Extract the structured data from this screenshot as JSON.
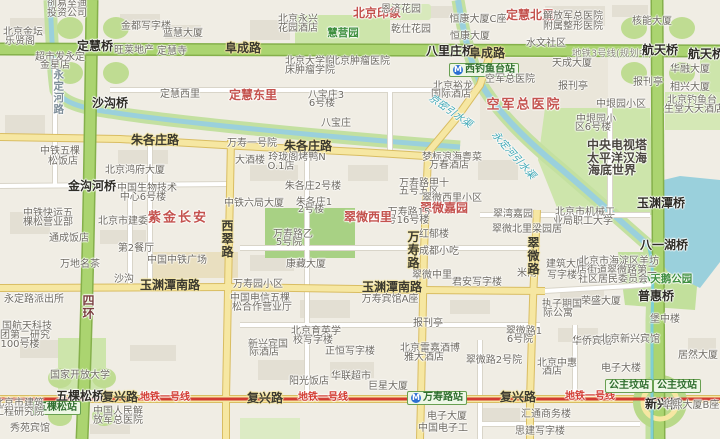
{
  "map": {
    "description": "Beijing street map around Fuxing Road / Wanshou Road / Gongzhufen",
    "colors": {
      "land": "#f0ede4",
      "park": "#cde5ab",
      "park_dark": "#a8d184",
      "highway_green": "#abd470",
      "highway_green_border": "#85b04b",
      "road_yellow": "#f6e7a2",
      "road_yellow_border": "#d9bd62",
      "road_white": "#ffffff",
      "road_white_border": "#d9d5c9",
      "water": "#9ad0dc",
      "water_bank": "#c3e0a0",
      "metro_line1_red": "#d23b32",
      "station_badge_bg": "#eef7e6",
      "station_badge_border": "#69a052",
      "district_label_red": "#c4524e",
      "building": "#e3dfd3"
    },
    "labels": [
      {
        "t": "北京印象",
        "c": "red",
        "x": 377,
        "y": 13
      },
      {
        "t": "定慧北里",
        "c": "red",
        "x": 530,
        "y": 15
      },
      {
        "t": "创易至迪",
        "c": "p",
        "x": 67,
        "y": 5
      },
      {
        "t": "投资公司",
        "c": "p",
        "x": 67,
        "y": 14
      },
      {
        "t": "北京金坛",
        "c": "p",
        "x": 23,
        "y": 33
      },
      {
        "t": "乐贤阁",
        "c": "p",
        "x": 20,
        "y": 42
      },
      {
        "t": "金都写字楼",
        "c": "p",
        "x": 146,
        "y": 27
      },
      {
        "t": "蓝慧大厦",
        "c": "p",
        "x": 183,
        "y": 34
      },
      {
        "t": "定慧桥",
        "c": "b",
        "x": 95,
        "y": 46
      },
      {
        "t": "旺莱地产",
        "c": "p",
        "x": 134,
        "y": 51
      },
      {
        "t": "定慧寺",
        "c": "p",
        "x": 172,
        "y": 52
      },
      {
        "t": "阜成路",
        "c": "r",
        "x": 243,
        "y": 48
      },
      {
        "t": "超市发永定",
        "c": "p",
        "x": 60,
        "y": 58
      },
      {
        "t": "金星店",
        "c": "p",
        "x": 55,
        "y": 66
      },
      {
        "t": "永定河路",
        "c": "vb",
        "x": 58,
        "y": 92
      },
      {
        "t": "定慧西里",
        "c": "p",
        "x": 180,
        "y": 95
      },
      {
        "t": "定慧东里",
        "c": "red",
        "x": 253,
        "y": 95
      },
      {
        "t": "北京永兴",
        "c": "p",
        "x": 298,
        "y": 20
      },
      {
        "t": "花园酒店",
        "c": "p",
        "x": 298,
        "y": 29
      },
      {
        "t": "慧营园",
        "c": "grn",
        "x": 343,
        "y": 33
      },
      {
        "t": "恩济花园",
        "c": "p",
        "x": 401,
        "y": 10
      },
      {
        "t": "乾仕花园",
        "c": "p",
        "x": 411,
        "y": 30
      },
      {
        "t": "八里庄桥",
        "c": "b",
        "x": 450,
        "y": 51
      },
      {
        "t": "北京裕龙",
        "c": "p",
        "x": 453,
        "y": 87
      },
      {
        "t": "国际酒店",
        "c": "p",
        "x": 451,
        "y": 95
      },
      {
        "t": "恒康大厦C座",
        "c": "p",
        "x": 478,
        "y": 20
      },
      {
        "t": "恒康大厦",
        "c": "p",
        "x": 470,
        "y": 37
      },
      {
        "t": "解放军总医院",
        "c": "p",
        "x": 573,
        "y": 17
      },
      {
        "t": "附属整形医院",
        "c": "p",
        "x": 573,
        "y": 27
      },
      {
        "t": "水文社区",
        "c": "p",
        "x": 546,
        "y": 44
      },
      {
        "t": "阜成路",
        "c": "r",
        "x": 487,
        "y": 53
      },
      {
        "t": "地铁3号线(规划中)",
        "c": "plan",
        "x": 612,
        "y": 54
      },
      {
        "t": "航天桥",
        "c": "b",
        "x": 660,
        "y": 50
      },
      {
        "t": "航天桥东",
        "c": "b",
        "x": 712,
        "y": 54
      },
      {
        "t": "核能大厦",
        "c": "p",
        "x": 652,
        "y": 22
      },
      {
        "t": "天成大厦",
        "c": "p",
        "x": 572,
        "y": 64
      },
      {
        "t": "华融大厦",
        "c": "p",
        "x": 690,
        "y": 70
      },
      {
        "t": "报刊亭",
        "c": "p",
        "x": 573,
        "y": 87
      },
      {
        "t": "报刊亭",
        "c": "p",
        "x": 648,
        "y": 83
      },
      {
        "t": "相兴大厦",
        "c": "p",
        "x": 690,
        "y": 88
      },
      {
        "t": "北京钓鱼台",
        "c": "p",
        "x": 692,
        "y": 101
      },
      {
        "t": "生堂大天酒店",
        "c": "p",
        "x": 694,
        "y": 110
      },
      {
        "t": "西钓鱼台站",
        "c": "mst",
        "x": 484,
        "y": 70
      },
      {
        "t": "空军总医院",
        "c": "p",
        "x": 510,
        "y": 80
      },
      {
        "t": "空军总医院",
        "c": "bigred",
        "x": 524,
        "y": 105
      },
      {
        "t": "沙沟桥",
        "c": "b",
        "x": 110,
        "y": 103
      },
      {
        "t": "朱各庄路",
        "c": "r",
        "x": 155,
        "y": 140
      },
      {
        "t": "朱各庄路",
        "c": "r",
        "x": 308,
        "y": 146
      },
      {
        "t": "中铁五棵",
        "c": "p",
        "x": 60,
        "y": 152
      },
      {
        "t": "松饭店",
        "c": "p",
        "x": 63,
        "y": 162
      },
      {
        "t": "北京鸿府大厦",
        "c": "p",
        "x": 135,
        "y": 171
      },
      {
        "t": "金沟河桥",
        "c": "b",
        "x": 92,
        "y": 186
      },
      {
        "t": "中国生物技术",
        "c": "p",
        "x": 147,
        "y": 189
      },
      {
        "t": "中心6号楼",
        "c": "p",
        "x": 143,
        "y": 198
      },
      {
        "t": "紫金长安",
        "c": "bigred",
        "x": 178,
        "y": 218
      },
      {
        "t": "万寿一号院",
        "c": "p",
        "x": 252,
        "y": 144
      },
      {
        "t": "大酒楼",
        "c": "p",
        "x": 250,
        "y": 161
      },
      {
        "t": "玲珑阁烤鸭N",
        "c": "p",
        "x": 297,
        "y": 158
      },
      {
        "t": "O.1店",
        "c": "p",
        "x": 281,
        "y": 167
      },
      {
        "t": "八宝庄",
        "c": "p",
        "x": 336,
        "y": 124
      },
      {
        "t": "八宝庄3",
        "c": "p",
        "x": 326,
        "y": 96
      },
      {
        "t": "6号楼",
        "c": "p",
        "x": 322,
        "y": 104
      },
      {
        "t": "北京大学临",
        "c": "p",
        "x": 310,
        "y": 62
      },
      {
        "t": "床肿瘤学院",
        "c": "p",
        "x": 310,
        "y": 71
      },
      {
        "t": "北京肿瘤医院",
        "c": "p",
        "x": 360,
        "y": 62
      },
      {
        "t": "京密引水渠",
        "c": "wat",
        "x": 450,
        "y": 112,
        "r": 35
      },
      {
        "t": "朱各庄2号楼",
        "c": "p",
        "x": 313,
        "y": 187
      },
      {
        "t": "朱各庄1",
        "c": "p",
        "x": 314,
        "y": 203
      },
      {
        "t": "2号楼",
        "c": "p",
        "x": 311,
        "y": 210
      },
      {
        "t": "中铁六局大厦",
        "c": "p",
        "x": 254,
        "y": 204
      },
      {
        "t": "梦标浪海粤菜",
        "c": "p",
        "x": 452,
        "y": 158
      },
      {
        "t": "万春酒店",
        "c": "p",
        "x": 449,
        "y": 166
      },
      {
        "t": "万寿路甲十",
        "c": "p",
        "x": 424,
        "y": 184
      },
      {
        "t": "五号五区",
        "c": "p",
        "x": 419,
        "y": 192
      },
      {
        "t": "翠微西里小区",
        "c": "p",
        "x": 452,
        "y": 199
      },
      {
        "t": "翠微嘉园",
        "c": "red",
        "x": 444,
        "y": 208
      },
      {
        "t": "万寿路15",
        "c": "p",
        "x": 409,
        "y": 213
      },
      {
        "t": "号16号楼",
        "c": "p",
        "x": 408,
        "y": 221
      },
      {
        "t": "翠微西里",
        "c": "red",
        "x": 368,
        "y": 217
      },
      {
        "t": "万寿路乙",
        "c": "p",
        "x": 293,
        "y": 235
      },
      {
        "t": "5号院",
        "c": "p",
        "x": 289,
        "y": 243
      },
      {
        "t": "康藏大厦",
        "c": "p",
        "x": 306,
        "y": 265
      },
      {
        "t": "万寿园小区",
        "c": "p",
        "x": 258,
        "y": 285
      },
      {
        "t": "红郁楼",
        "c": "p",
        "x": 434,
        "y": 235
      },
      {
        "t": "成都小吃",
        "c": "p",
        "x": 439,
        "y": 252
      },
      {
        "t": "翠微中里",
        "c": "p",
        "x": 432,
        "y": 276
      },
      {
        "t": "君安写字楼",
        "c": "p",
        "x": 477,
        "y": 283
      },
      {
        "t": "米南",
        "c": "p",
        "x": 527,
        "y": 274
      },
      {
        "t": "万寿路",
        "c": "v",
        "x": 413,
        "y": 250
      },
      {
        "t": "玉渊潭南路",
        "c": "r",
        "x": 170,
        "y": 285
      },
      {
        "t": "玉渊潭南路",
        "c": "r",
        "x": 392,
        "y": 287
      },
      {
        "t": "沙沟",
        "c": "p",
        "x": 124,
        "y": 280
      },
      {
        "t": "西翠路",
        "c": "v",
        "x": 227,
        "y": 239
      },
      {
        "t": "中国中铁广场",
        "c": "p",
        "x": 177,
        "y": 261
      },
      {
        "t": "万地名茶",
        "c": "p",
        "x": 80,
        "y": 265
      },
      {
        "t": "第2餐厅",
        "c": "p",
        "x": 136,
        "y": 249
      },
      {
        "t": "北京市建委",
        "c": "p",
        "x": 123,
        "y": 222
      },
      {
        "t": "通成饭店",
        "c": "p",
        "x": 69,
        "y": 239
      },
      {
        "t": "中铁快运五",
        "c": "p",
        "x": 48,
        "y": 214
      },
      {
        "t": "棵松营业部",
        "c": "p",
        "x": 48,
        "y": 223
      },
      {
        "t": "永定路派出所",
        "c": "p",
        "x": 34,
        "y": 300
      },
      {
        "t": "四环",
        "c": "v4",
        "x": 88,
        "y": 307
      },
      {
        "t": "中国电信五棵",
        "c": "p",
        "x": 260,
        "y": 299
      },
      {
        "t": "松合作营业厅",
        "c": "p",
        "x": 262,
        "y": 308
      },
      {
        "t": "万寿宾馆A座",
        "c": "p",
        "x": 390,
        "y": 300
      },
      {
        "t": "报刊亭",
        "c": "p",
        "x": 428,
        "y": 324
      },
      {
        "t": "中垠园小区",
        "c": "p",
        "x": 621,
        "y": 105
      },
      {
        "t": "中垠园小",
        "c": "p",
        "x": 596,
        "y": 120
      },
      {
        "t": "区6号楼",
        "c": "p",
        "x": 593,
        "y": 128
      },
      {
        "t": "中央电视塔",
        "c": "big",
        "x": 617,
        "y": 145
      },
      {
        "t": "太平洋汉海",
        "c": "big",
        "x": 617,
        "y": 158
      },
      {
        "t": "海底世界",
        "c": "big",
        "x": 612,
        "y": 170
      },
      {
        "t": "永定河引水渠",
        "c": "wat",
        "x": 513,
        "y": 156,
        "r": 48
      },
      {
        "t": "玉渊潭桥",
        "c": "b",
        "x": 661,
        "y": 203
      },
      {
        "t": "八一湖桥",
        "c": "b",
        "x": 664,
        "y": 245
      },
      {
        "t": "小天鹅公园",
        "c": "grn",
        "x": 666,
        "y": 279
      },
      {
        "t": "普惠桥",
        "c": "b",
        "x": 656,
        "y": 296
      },
      {
        "t": "北京市机械工",
        "c": "p",
        "x": 585,
        "y": 213
      },
      {
        "t": "业局职工大学",
        "c": "p",
        "x": 583,
        "y": 222
      },
      {
        "t": "翠湾嘉园",
        "c": "p",
        "x": 513,
        "y": 215
      },
      {
        "t": "翠微北里",
        "c": "p",
        "x": 512,
        "y": 230
      },
      {
        "t": "梁园居",
        "c": "p",
        "x": 547,
        "y": 230
      },
      {
        "t": "建筑大厦",
        "c": "p",
        "x": 566,
        "y": 265
      },
      {
        "t": "写字楼",
        "c": "p",
        "x": 562,
        "y": 276
      },
      {
        "t": "北京市海淀区羊坊",
        "c": "p",
        "x": 619,
        "y": 262
      },
      {
        "t": "店街道翠微路第二",
        "c": "p",
        "x": 617,
        "y": 271
      },
      {
        "t": "社区居民委员会",
        "c": "p",
        "x": 613,
        "y": 280
      },
      {
        "t": "荣盛大厦",
        "c": "p",
        "x": 601,
        "y": 302
      },
      {
        "t": "执子期国",
        "c": "p",
        "x": 562,
        "y": 305
      },
      {
        "t": "际公寓",
        "c": "p",
        "x": 558,
        "y": 314
      },
      {
        "t": "堡中楼",
        "c": "p",
        "x": 665,
        "y": 320
      },
      {
        "t": "翠微路",
        "c": "v",
        "x": 533,
        "y": 256
      },
      {
        "t": "国航天科技",
        "c": "p",
        "x": 27,
        "y": 327
      },
      {
        "t": "团第二研究",
        "c": "p",
        "x": 25,
        "y": 336
      },
      {
        "t": "100号楼",
        "c": "p",
        "x": 20,
        "y": 345
      },
      {
        "t": "国家开放大学",
        "c": "p",
        "x": 80,
        "y": 376
      },
      {
        "t": "五棵松桥",
        "c": "b",
        "x": 80,
        "y": 396
      },
      {
        "t": "复兴路",
        "c": "r",
        "x": 120,
        "y": 397
      },
      {
        "t": "地铁一号线",
        "c": "sub",
        "x": 165,
        "y": 398
      },
      {
        "t": "复兴路",
        "c": "r",
        "x": 265,
        "y": 398
      },
      {
        "t": "地铁一号线",
        "c": "sub",
        "x": 323,
        "y": 398
      },
      {
        "t": "复兴路",
        "c": "r",
        "x": 518,
        "y": 397
      },
      {
        "t": "地铁一号线",
        "c": "sub",
        "x": 590,
        "y": 397
      },
      {
        "t": "五棵松站",
        "c": "st",
        "x": 57,
        "y": 408
      },
      {
        "t": "北京市建筑",
        "c": "p",
        "x": 19,
        "y": 404
      },
      {
        "t": "工程研究院",
        "c": "p",
        "x": 19,
        "y": 413
      },
      {
        "t": "中国人民解",
        "c": "p",
        "x": 118,
        "y": 412
      },
      {
        "t": "放军总医院",
        "c": "p",
        "x": 118,
        "y": 421
      },
      {
        "t": "秀苑宾馆",
        "c": "p",
        "x": 30,
        "y": 429
      },
      {
        "t": "北京育英学",
        "c": "p",
        "x": 316,
        "y": 332
      },
      {
        "t": "校写字楼",
        "c": "p",
        "x": 313,
        "y": 341
      },
      {
        "t": "新兴宾国",
        "c": "p",
        "x": 268,
        "y": 345
      },
      {
        "t": "际酒店",
        "c": "p",
        "x": 264,
        "y": 353
      },
      {
        "t": "正恒写字楼",
        "c": "p",
        "x": 350,
        "y": 352
      },
      {
        "t": "华联超市",
        "c": "p",
        "x": 351,
        "y": 377
      },
      {
        "t": "阳光饭店",
        "c": "p",
        "x": 309,
        "y": 382
      },
      {
        "t": "巨星大厦",
        "c": "p",
        "x": 388,
        "y": 387
      },
      {
        "t": "北京雷嘉酒博",
        "c": "p",
        "x": 430,
        "y": 349
      },
      {
        "t": "雅大酒店",
        "c": "p",
        "x": 424,
        "y": 358
      },
      {
        "t": "翠微路2号院",
        "c": "p",
        "x": 494,
        "y": 361
      },
      {
        "t": "万寿路站",
        "c": "mst",
        "x": 437,
        "y": 398
      },
      {
        "t": "电子大厦",
        "c": "p",
        "x": 447,
        "y": 417
      },
      {
        "t": "中国电子工",
        "c": "p",
        "x": 443,
        "y": 429
      },
      {
        "t": "翠微路1",
        "c": "p",
        "x": 524,
        "y": 332
      },
      {
        "t": "6号院",
        "c": "p",
        "x": 520,
        "y": 340
      },
      {
        "t": "华侨宾馆",
        "c": "p",
        "x": 592,
        "y": 342
      },
      {
        "t": "北京新兴宾馆",
        "c": "p",
        "x": 630,
        "y": 340
      },
      {
        "t": "北京中惠",
        "c": "p",
        "x": 557,
        "y": 364
      },
      {
        "t": "酒店",
        "c": "p",
        "x": 552,
        "y": 372
      },
      {
        "t": "电子大楼",
        "c": "p",
        "x": 621,
        "y": 369
      },
      {
        "t": "公主坟站",
        "c": "st",
        "x": 629,
        "y": 386
      },
      {
        "t": "公主坟站",
        "c": "st",
        "x": 677,
        "y": 386
      },
      {
        "t": "新兴桥",
        "c": "b",
        "x": 663,
        "y": 404
      },
      {
        "t": "汇通商务楼",
        "c": "p",
        "x": 546,
        "y": 415
      },
      {
        "t": "思建写字楼",
        "c": "p",
        "x": 540,
        "y": 432
      },
      {
        "t": "居然大厦",
        "c": "p",
        "x": 698,
        "y": 356
      },
      {
        "t": "华熙大厦B座",
        "c": "p",
        "x": 691,
        "y": 406
      }
    ]
  }
}
